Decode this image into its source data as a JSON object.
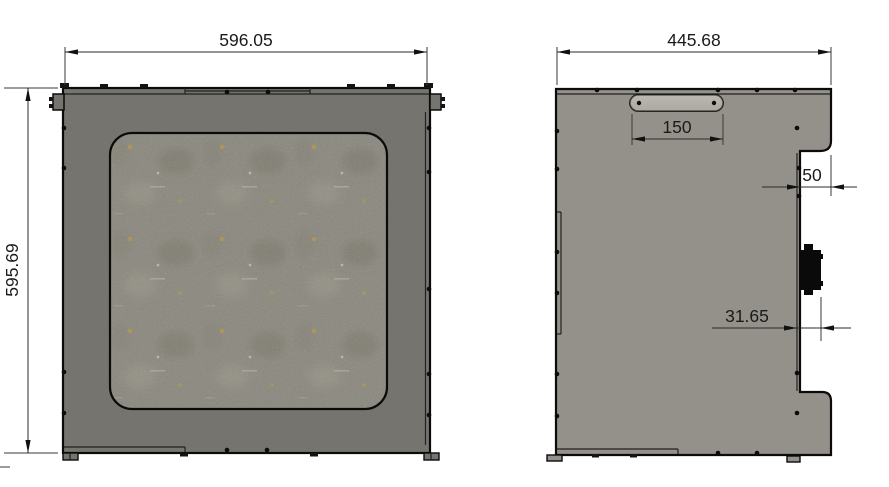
{
  "views": {
    "front": {
      "width_dim": "596.05",
      "height_dim": "595.69"
    },
    "side": {
      "width_dim": "445.68",
      "handle_dim": "150",
      "step_dim": "50",
      "connector_dim": "31.65"
    }
  },
  "colors": {
    "background": "#ffffff",
    "outline": "#0b0b0b",
    "front_panel": "#75746e",
    "side_panel": "#93918a",
    "window_texture_base": "#8b897f",
    "handle": "#b2b0a8",
    "dimension_line": "#2b2b2b",
    "dimension_text": "#1a1a1a"
  }
}
